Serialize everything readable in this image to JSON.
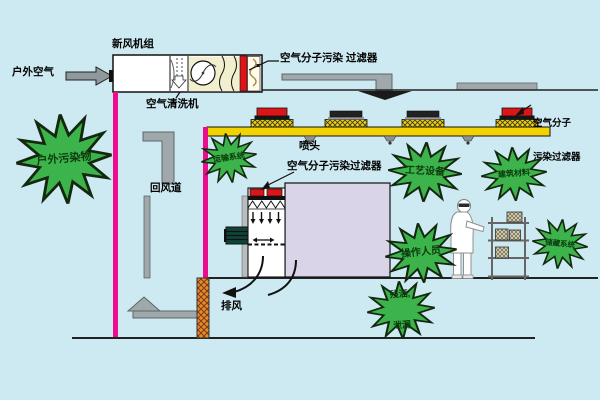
{
  "ahu": {
    "title": "新风机组",
    "inlet_label": "户外空气",
    "washer_label": "空气清洗机",
    "filter_label": "空气分子污染 过滤器"
  },
  "ceiling_duct": {
    "filter_label_line1": "空气分子",
    "filter_label_line2": "污染过滤器",
    "nozzle_label": "喷头"
  },
  "bench": {
    "filter_label": "空气分子污染过滤器"
  },
  "airflow": {
    "return_duct_label": "回风道",
    "exhaust_label": "排风"
  },
  "contamination_sources": [
    {
      "id": "outdoor-pollutants",
      "label": "户外污染物"
    },
    {
      "id": "transport-system",
      "label": "运输系统"
    },
    {
      "id": "process-equipment",
      "label": "工艺设备"
    },
    {
      "id": "building-materials",
      "label": "建筑材料"
    },
    {
      "id": "operators",
      "label": "操作人员"
    },
    {
      "id": "storage-system",
      "label": "储藏系统"
    },
    {
      "id": "spills-leaks",
      "label": "残洒, 泄漏",
      "label_line1": "残洒,",
      "label_line2": "泄漏"
    }
  ],
  "colors": {
    "background": "#cdeaf2",
    "wall_magenta": "#ec0c8c",
    "ceiling_duct_yellow": "#f2d200",
    "filter_red": "#dd1518",
    "starburst_green": "#3cb44b",
    "process_box_purple": "#d9d4e8",
    "floor_column_orange": "#e58a2f",
    "duct_gray": "#9fa8ab"
  }
}
